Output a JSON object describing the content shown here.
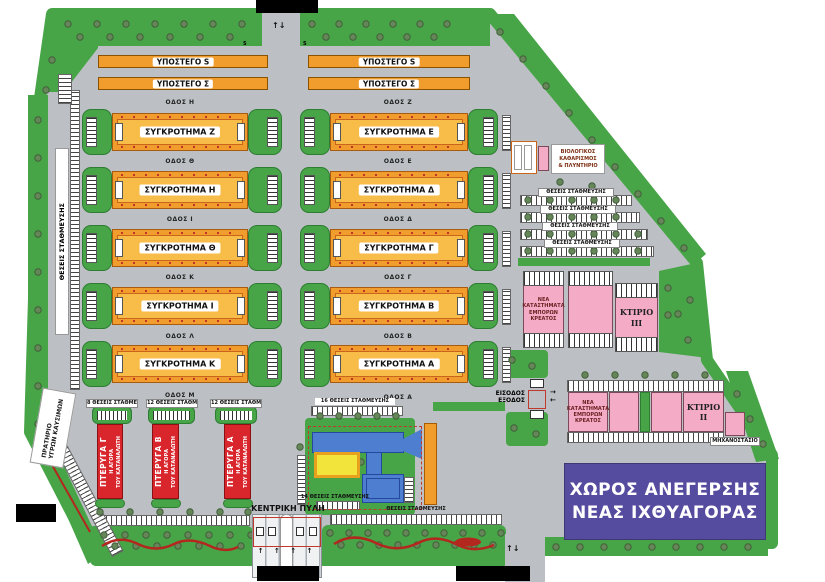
{
  "colors": {
    "asphalt": "#bcc0c4",
    "green": "#47a447",
    "building_orange": "#f09d2d",
    "building_orange_inner": "#f8bc49",
    "wing_red": "#d8262c",
    "shops_pink": "#f3abc6",
    "notice_purple": "#564c9f",
    "facility_blue": "#4d7ecf",
    "facility_yellow": "#f2e43b",
    "hedge_red": "#b3271f"
  },
  "sheds": [
    "ΥΠΟΣΤΕΓΟ S",
    "ΥΠΟΣΤΕΓΟ Σ",
    "ΥΠΟΣΤΕΓΟ S",
    "ΥΠΟΣΤΕΓΟ Σ"
  ],
  "buildings": {
    "left": [
      "ΣΥΓΚΡΟΤΗΜΑ Ζ",
      "ΣΥΓΚΡΟΤΗΜΑ Η",
      "ΣΥΓΚΡΟΤΗΜΑ Θ",
      "ΣΥΓΚΡΟΤΗΜΑ Ι",
      "ΣΥΓΚΡΟΤΗΜΑ Κ"
    ],
    "right": [
      "ΣΥΓΚΡΟΤΗΜΑ Ε",
      "ΣΥΓΚΡΟΤΗΜΑ Δ",
      "ΣΥΓΚΡΟΤΗΜΑ Γ",
      "ΣΥΓΚΡΟΤΗΜΑ Β",
      "ΣΥΓΚΡΟΤΗΜΑ Α"
    ]
  },
  "roads": {
    "left": [
      "ΟΔΟΣ Η",
      "ΟΔΟΣ Θ",
      "ΟΔΟΣ Ι",
      "ΟΔΟΣ Κ",
      "ΟΔΟΣ Λ",
      "ΟΔΟΣ Μ"
    ],
    "right": [
      "ΟΔΟΣ Ζ",
      "ΟΔΟΣ Ε",
      "ΟΔΟΣ Δ",
      "ΟΔΟΣ Γ",
      "ΟΔΟΣ Β",
      "ΟΔΟΣ Α"
    ]
  },
  "wings": [
    {
      "name": "ΠΤΕΡΥΓΑ Γ",
      "line2": "Η ΑΓΟΡΑ",
      "line3": "ΤΟΥ ΚΑΤΑΝΑΛΩΤΗ",
      "parking": "8 ΘΕΣΕΙΣ ΣΤΑΘΜΕΥΣΗΣ"
    },
    {
      "name": "ΠΤΕΡΥΓΑ Β",
      "line2": "Η ΑΓΟΡΑ",
      "line3": "ΤΟΥ ΚΑΤΑΝΑΛΩΤΗ",
      "parking": "12 ΘΕΣΕΙΣ ΣΤΑΘΜΕΥΣΗΣ"
    },
    {
      "name": "ΠΤΕΡΥΓΑ Α",
      "line2": "Η ΑΓΟΡΑ",
      "line3": "ΤΟΥ ΚΑΤΑΝΑΛΩΤΗ",
      "parking": "12 ΘΕΣΕΙΣ ΣΤΑΘΜΕΥΣΗΣ"
    }
  ],
  "parking": {
    "left_strip": "ΘΕΣΕΙΣ ΣΤΑΘΜΕΥΣΗΣ",
    "center_top": "16 ΘΕΣΕΙΣ ΣΤΑΘΜΕΥΣΗΣ",
    "center_bottom": "14 ΘΕΣΕΙΣ ΣΤΑΘΜΕΥΣΗΣ",
    "right_rows": [
      "ΘΕΣΕΙΣ ΣΤΑΘΜΕΥΣΗΣ",
      "ΘΕΣΕΙΣ ΣΤΑΘΜΕΥΣΗΣ",
      "ΘΕΣΕΙΣ ΣΤΑΘΜΕΥΣΗΣ",
      "ΘΕΣΕΙΣ ΣΤΑΘΜΕΥΣΗΣ"
    ],
    "bottom_strip": "ΘΕΣΕΙΣ ΣΤΑΘΜΕΥΣΗΣ"
  },
  "labels": {
    "fuel_station": "ΠΡΑΤΗΡΙΟ\nΥΓΡΩΝ ΚΑΥΣΙΜΩΝ",
    "bio_treatment": "ΒΙΟΛΟΓΙΚΟΣ\nΚΑΘΑΡΙΣΜΟΣ\n& ΠΛΥΝΤΗΡΙΟ",
    "meat_shops": "ΝΕΑ\nΚΑΤΑΣΤΗΜΑΤΑ\nΕΜΠΟΡΩΝ\nΚΡΕΑΤΟΣ",
    "building3": "ΚΤΙΡΙΟ\nIII",
    "building2": "ΚΤΙΡΙΟ\nII",
    "machine_room": "ΜΗΧΑΝΟΣΤΑΣΙΟ",
    "fish_market": "ΧΩΡΟΣ ΑΝΕΓΕΡΣΗΣ\nΝΕΑΣ ΙΧΘΥΑΓΟΡΑΣ",
    "central_gate": "ΚΕΝΤΡΙΚΗ ΠΥΛΗ",
    "entrance_exit": "ΕΙΣΟΔΟΣ\nΕΞΟΔΟΣ",
    "s_marker": "S"
  },
  "arrows": {
    "two_way_vertical": "↑↓",
    "right": "→",
    "left": "←",
    "lane_up": "↑ ↑ ↑ ↑"
  }
}
